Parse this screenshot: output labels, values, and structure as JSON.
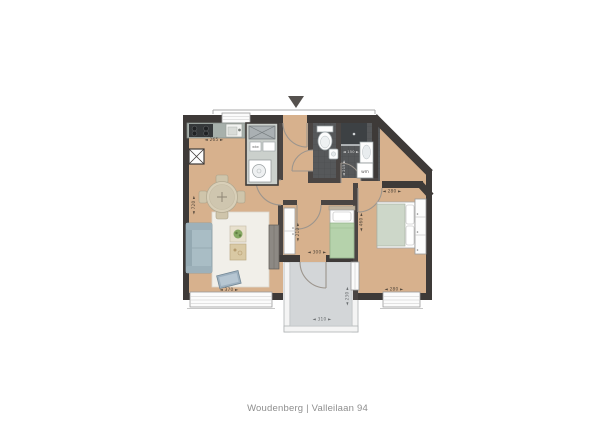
{
  "caption": "Woudenberg | Valleilaan 94",
  "plan": {
    "appliance_labels": {
      "washing_machine": "wm",
      "ventilation_unit": "wtw"
    },
    "dimensions": {
      "kitchen_width": "◄ 265 ►",
      "living_height": "◄ 720 ►",
      "living_width": "◄ 370 ►",
      "bedroom2_width": "◄ 300 ►",
      "bedroom2_height": "◄ 210 ►",
      "bedroom1_width_top": "◄ 280 ►",
      "bedroom1_height": "◄ 460 ►",
      "bedroom1_width_bottom": "◄ 280 ►",
      "bathroom_width": "◄ 150 ►",
      "bathroom_height": "◄ 215 ►",
      "balcony_width": "◄ 310 ►",
      "balcony_height": "◄ 230 ►"
    },
    "colors": {
      "floor": "#d7b18d",
      "exterior_wall": "#3e3a38",
      "interior_wall": "#4a4543",
      "bathroom_tile": "#56585a",
      "balcony_floor": "#d3d6d8",
      "bed_green": "#b5d2ab",
      "sofa_blue": "#a9bdc5",
      "caption_grey": "#8e8e8e"
    }
  }
}
